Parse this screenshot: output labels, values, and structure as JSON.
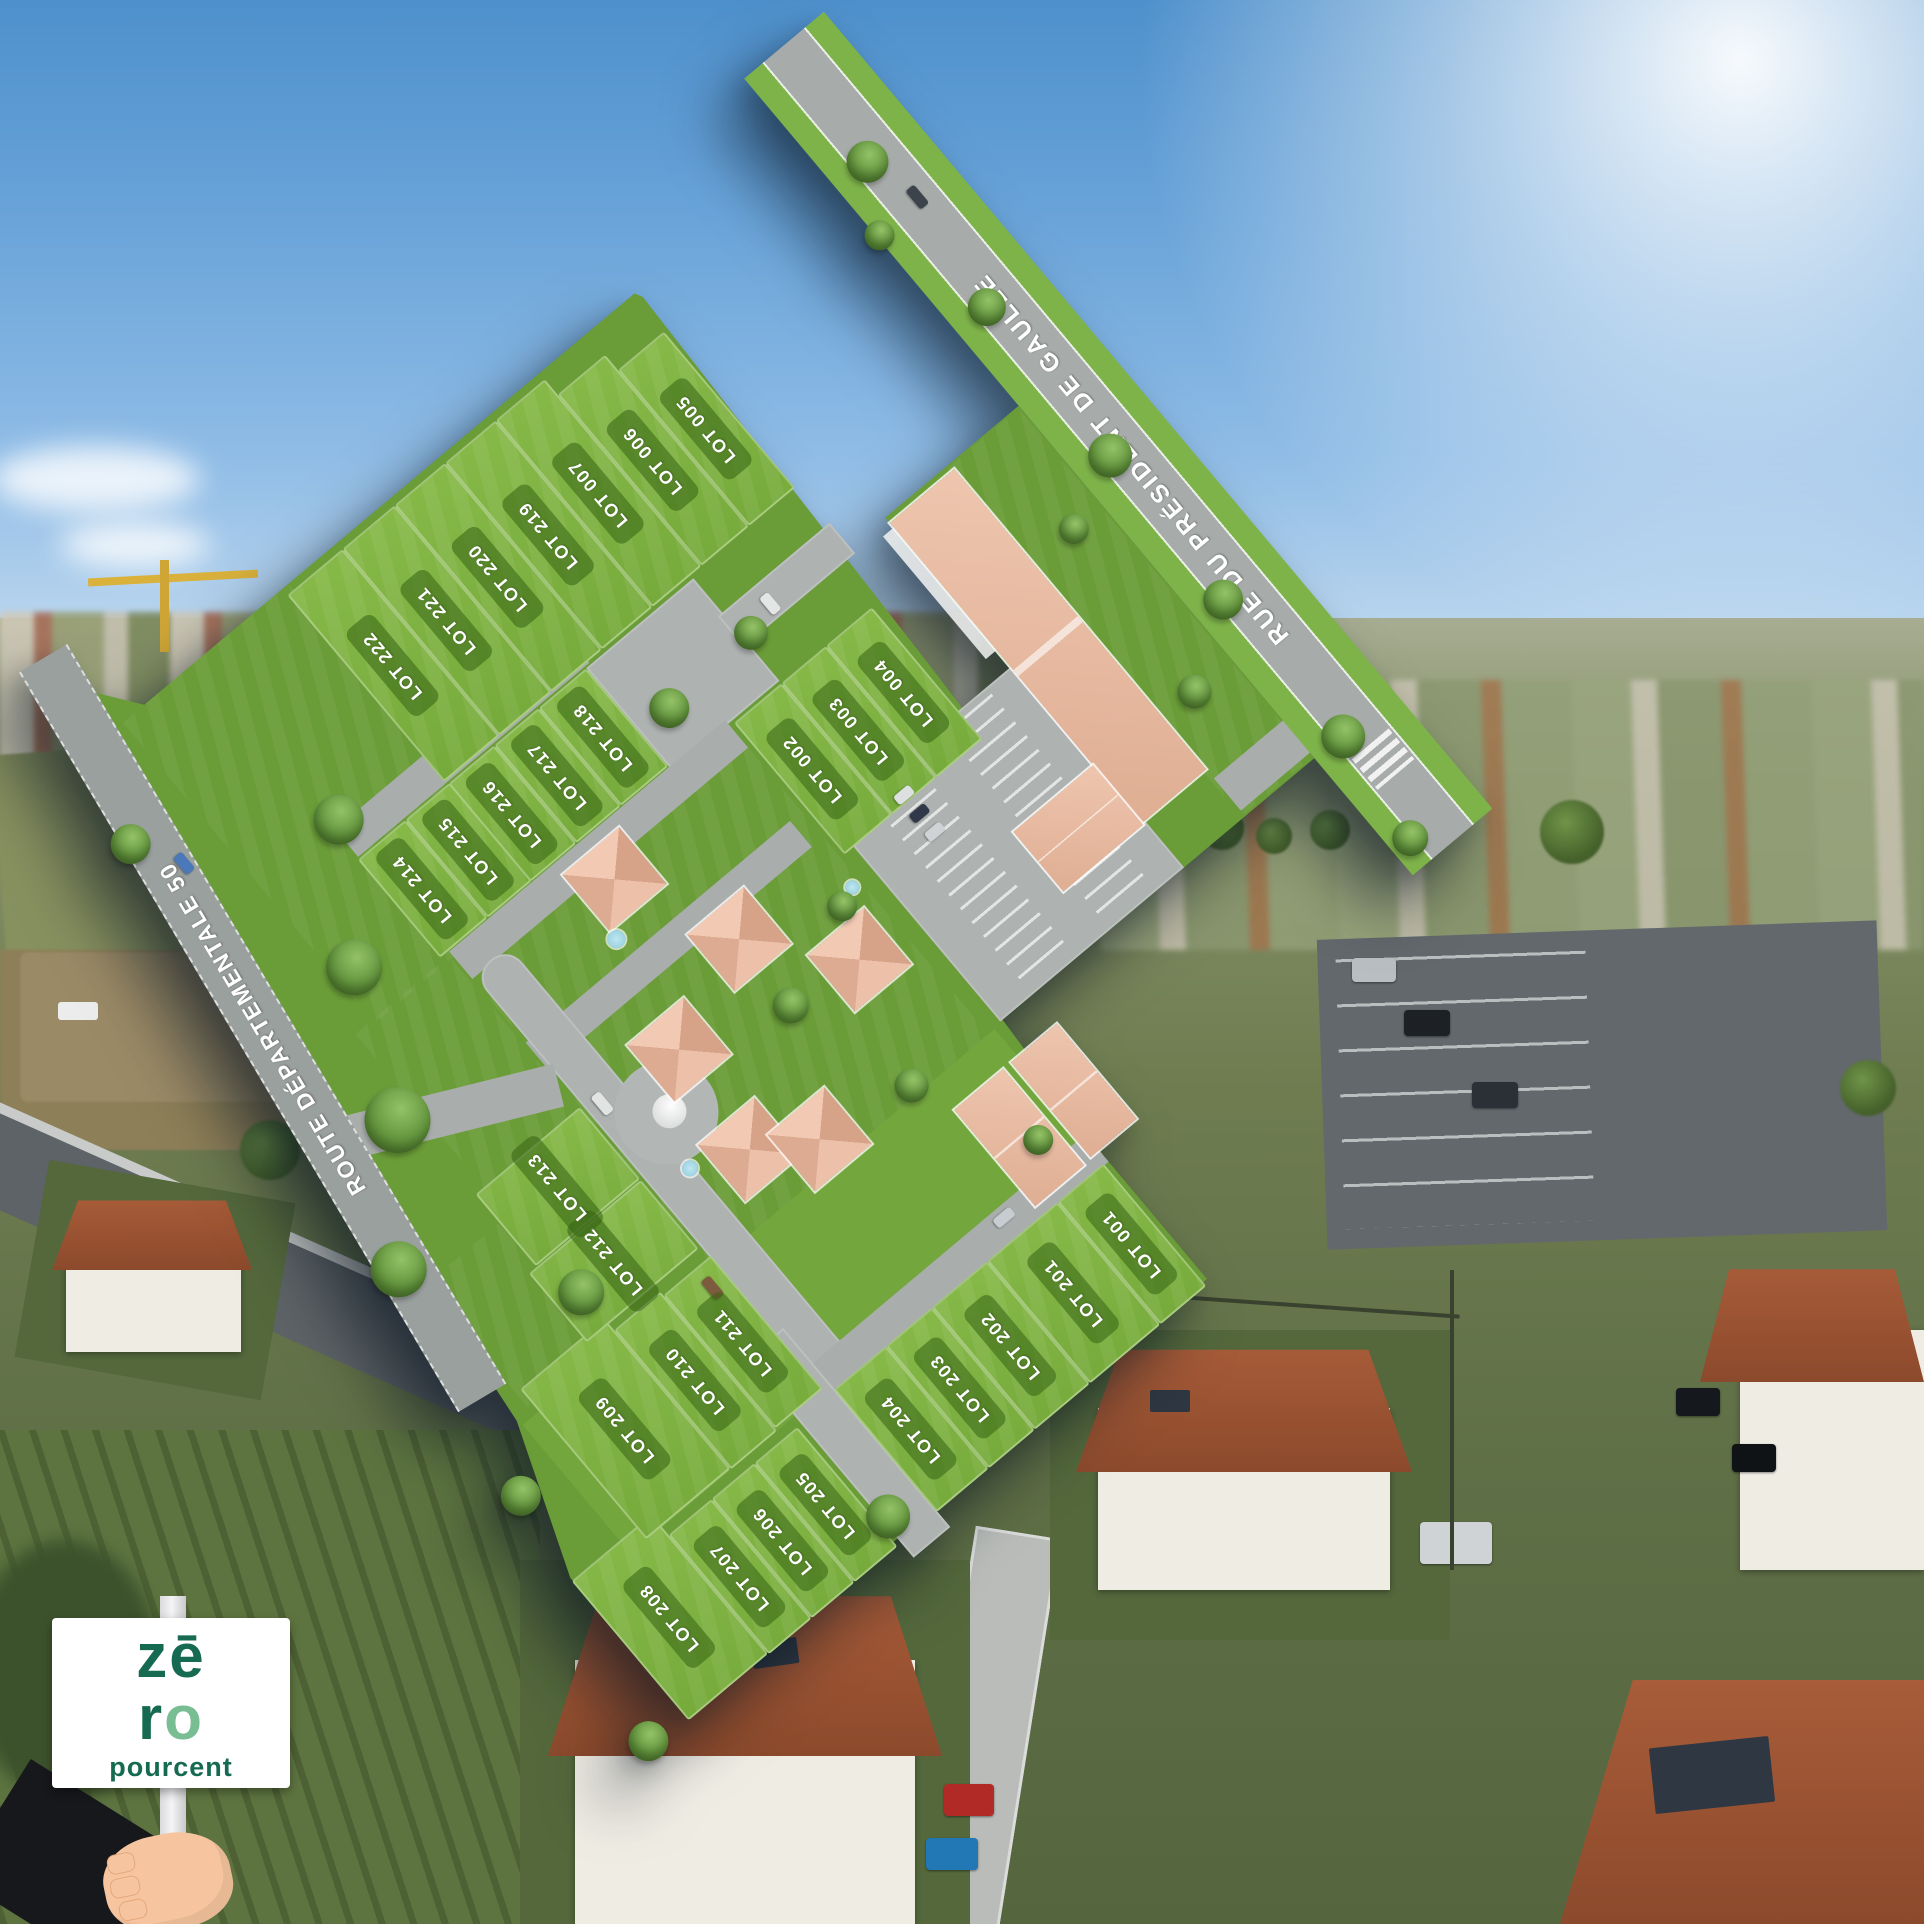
{
  "plan": {
    "streets": {
      "gaulle": "RUE DU PRÉSIDENT DE GAULLE",
      "rd50": "ROUTE DÉPARTEMENTALE 50"
    },
    "lots": [
      {
        "id": "001",
        "label": "LOT 001"
      },
      {
        "id": "002",
        "label": "LOT 002"
      },
      {
        "id": "003",
        "label": "LOT 003"
      },
      {
        "id": "004",
        "label": "LOT 004"
      },
      {
        "id": "005",
        "label": "LOT 005"
      },
      {
        "id": "006",
        "label": "LOT 006"
      },
      {
        "id": "007",
        "label": "LOT 007"
      },
      {
        "id": "201",
        "label": "LOT 201"
      },
      {
        "id": "202",
        "label": "LOT 202"
      },
      {
        "id": "203",
        "label": "LOT 203"
      },
      {
        "id": "204",
        "label": "LOT 204"
      },
      {
        "id": "205",
        "label": "LOT 205"
      },
      {
        "id": "206",
        "label": "LOT 206"
      },
      {
        "id": "207",
        "label": "LOT 207"
      },
      {
        "id": "208",
        "label": "LOT 208"
      },
      {
        "id": "209",
        "label": "LOT 209"
      },
      {
        "id": "210",
        "label": "LOT 210"
      },
      {
        "id": "211",
        "label": "LOT 211"
      },
      {
        "id": "212",
        "label": "LOT 212"
      },
      {
        "id": "213",
        "label": "LOT 213"
      },
      {
        "id": "214",
        "label": "LOT 214"
      },
      {
        "id": "215",
        "label": "LOT 215"
      },
      {
        "id": "216",
        "label": "LOT 216"
      },
      {
        "id": "217",
        "label": "LOT 217"
      },
      {
        "id": "218",
        "label": "LOT 218"
      },
      {
        "id": "219",
        "label": "LOT 219"
      },
      {
        "id": "220",
        "label": "LOT 220"
      },
      {
        "id": "221",
        "label": "LOT 221"
      },
      {
        "id": "222",
        "label": "LOT 222"
      }
    ]
  },
  "logo": {
    "line1": "zē",
    "r": "r",
    "o": "o",
    "word": "pourcent"
  },
  "colors": {
    "lot_green": "#7cae42",
    "lot_label_bg": "#55882a",
    "road_gray": "#a7acaa",
    "roof_pink": "#e7bca3",
    "logo_dark": "#166a52",
    "logo_light": "#79bd92",
    "sky_blue": "#6aa4d9"
  }
}
